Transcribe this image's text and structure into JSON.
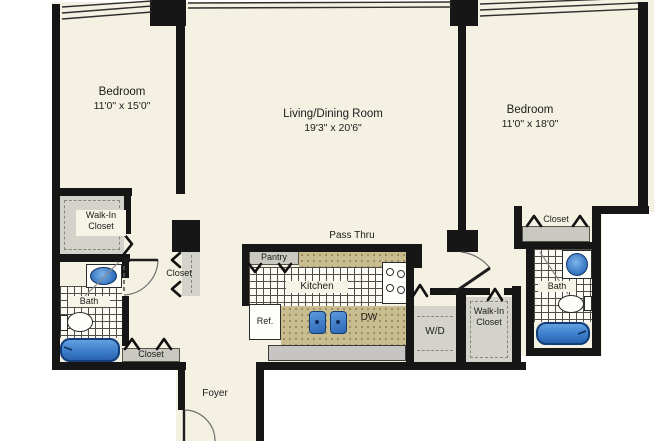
{
  "plan": {
    "bedroom_left": {
      "name": "Bedroom",
      "dims": "11'0\" x 15'0\""
    },
    "living_dining": {
      "name": "Living/Dining Room",
      "dims": "19'3\" x 20'6\""
    },
    "bedroom_right": {
      "name": "Bedroom",
      "dims": "11'0\" x 18'0\""
    },
    "walk_in_closet_left": "Walk-In Closet",
    "closet_hall_left": "Closet",
    "bath_left": "Bath",
    "closet_bath_left": "Closet",
    "foyer": "Foyer",
    "pass_thru": "Pass Thru",
    "pantry": "Pantry",
    "kitchen": "Kitchen",
    "refrigerator": "Ref.",
    "dishwasher": "DW",
    "washer_dryer": "W/D",
    "walk_in_closet_right": "Walk-In Closet",
    "closet_right": "Closet",
    "bath_right": "Bath",
    "colors": {
      "wall_black": "#161616",
      "floor_cream": "#f4f0e2",
      "closet_gray": "#d4d3cb",
      "counter_tan": "#c9bd8f",
      "fixture_blue": "#3c7ecb"
    }
  }
}
